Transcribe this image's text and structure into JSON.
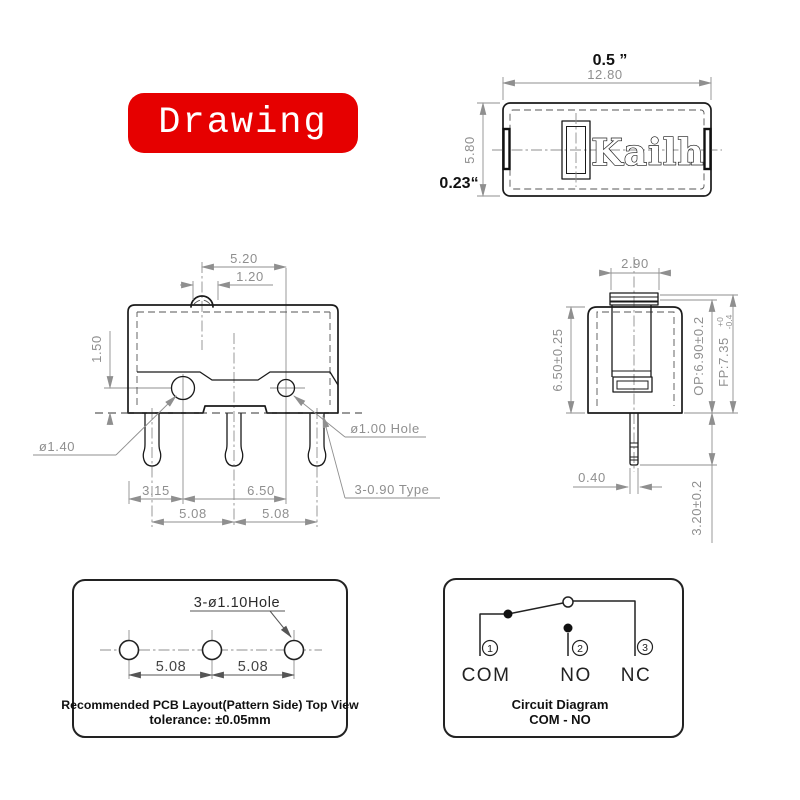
{
  "banner": {
    "label": "Drawing"
  },
  "top_view": {
    "brand": "Kailh",
    "dim_in_width": "0.5 ”",
    "dim_mm_width": "12.80",
    "dim_mm_height": "5.80",
    "dim_in_height": "0.23“"
  },
  "front_view": {
    "dim_pitch_top": "5.20",
    "dim_button_width": "1.20",
    "dim_hole_height": "1.50",
    "dim_edge_to_hole": "3.15",
    "dim_hole_pitch": "6.50",
    "dim_pin_pitch_left": "5.08",
    "dim_pin_pitch_right": "5.08",
    "label_left_hole": "ø1.40",
    "label_right_hole": "ø1.00 Hole",
    "label_pins": "3-0.90 Type"
  },
  "side_view": {
    "dim_plunger_width": "2.90",
    "dim_body_height": "6.50±0.25",
    "dim_op": "OP:6.90±0.2",
    "dim_fp": "FP:7.35",
    "fp_tol_upper": "+0",
    "fp_tol_lower": "-0.4",
    "dim_pin_width": "0.40",
    "dim_pin_length": "3.20±0.2"
  },
  "pcb_layout": {
    "hole_label": "3-ø1.10Hole",
    "dim_pitch_left": "5.08",
    "dim_pitch_right": "5.08",
    "caption_line1": "Recommended PCB Layout(Pattern Side) Top View",
    "caption_line2": "tolerance: ±0.05mm"
  },
  "circuit": {
    "terminals": [
      {
        "num": "1",
        "label": "COM"
      },
      {
        "num": "2",
        "label": "NO"
      },
      {
        "num": "3",
        "label": "NC"
      }
    ],
    "caption_line1": "Circuit Diagram",
    "caption_line2": "COM - NO"
  },
  "colors": {
    "accent_red": "#e60000",
    "line_dark": "#1a1a1a",
    "dim_gray": "#8f8f8f"
  }
}
